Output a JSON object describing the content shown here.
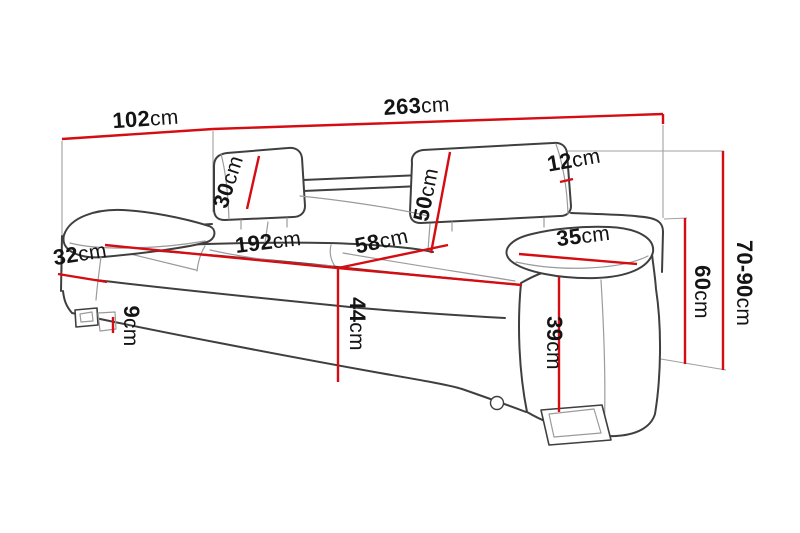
{
  "diagram": {
    "type": "furniture-dimension-diagram",
    "subject": "three-seat sofa with adjustable headrests, perspective line drawing",
    "unit": "cm",
    "colors": {
      "dimension_line": "#d50c11",
      "sofa_outline": "#3f3f3f",
      "sofa_inner_line": "#9b9b9b",
      "extension_line": "#a0a0a0",
      "label_text": "#141414",
      "background": "#ffffff"
    },
    "dimensions": [
      {
        "id": "total-depth",
        "value": "102",
        "unit": "cm"
      },
      {
        "id": "total-width",
        "value": "263",
        "unit": "cm"
      },
      {
        "id": "headrest-thickness",
        "value": "12",
        "unit": "cm"
      },
      {
        "id": "headrest-height",
        "value": "30",
        "unit": "cm"
      },
      {
        "id": "backrest-height",
        "value": "50",
        "unit": "cm"
      },
      {
        "id": "armrest-top-width",
        "value": "35",
        "unit": "cm"
      },
      {
        "id": "armrest-top-depth",
        "value": "32",
        "unit": "cm"
      },
      {
        "id": "seat-width",
        "value": "192",
        "unit": "cm"
      },
      {
        "id": "seat-depth",
        "value": "58",
        "unit": "cm"
      },
      {
        "id": "seat-height",
        "value": "44",
        "unit": "cm"
      },
      {
        "id": "leg-height",
        "value": "9",
        "unit": "cm"
      },
      {
        "id": "armrest-height",
        "value": "39",
        "unit": "cm"
      },
      {
        "id": "side-height",
        "value": "60",
        "unit": "cm"
      },
      {
        "id": "total-height",
        "value": "70-90",
        "unit": "cm"
      }
    ]
  }
}
